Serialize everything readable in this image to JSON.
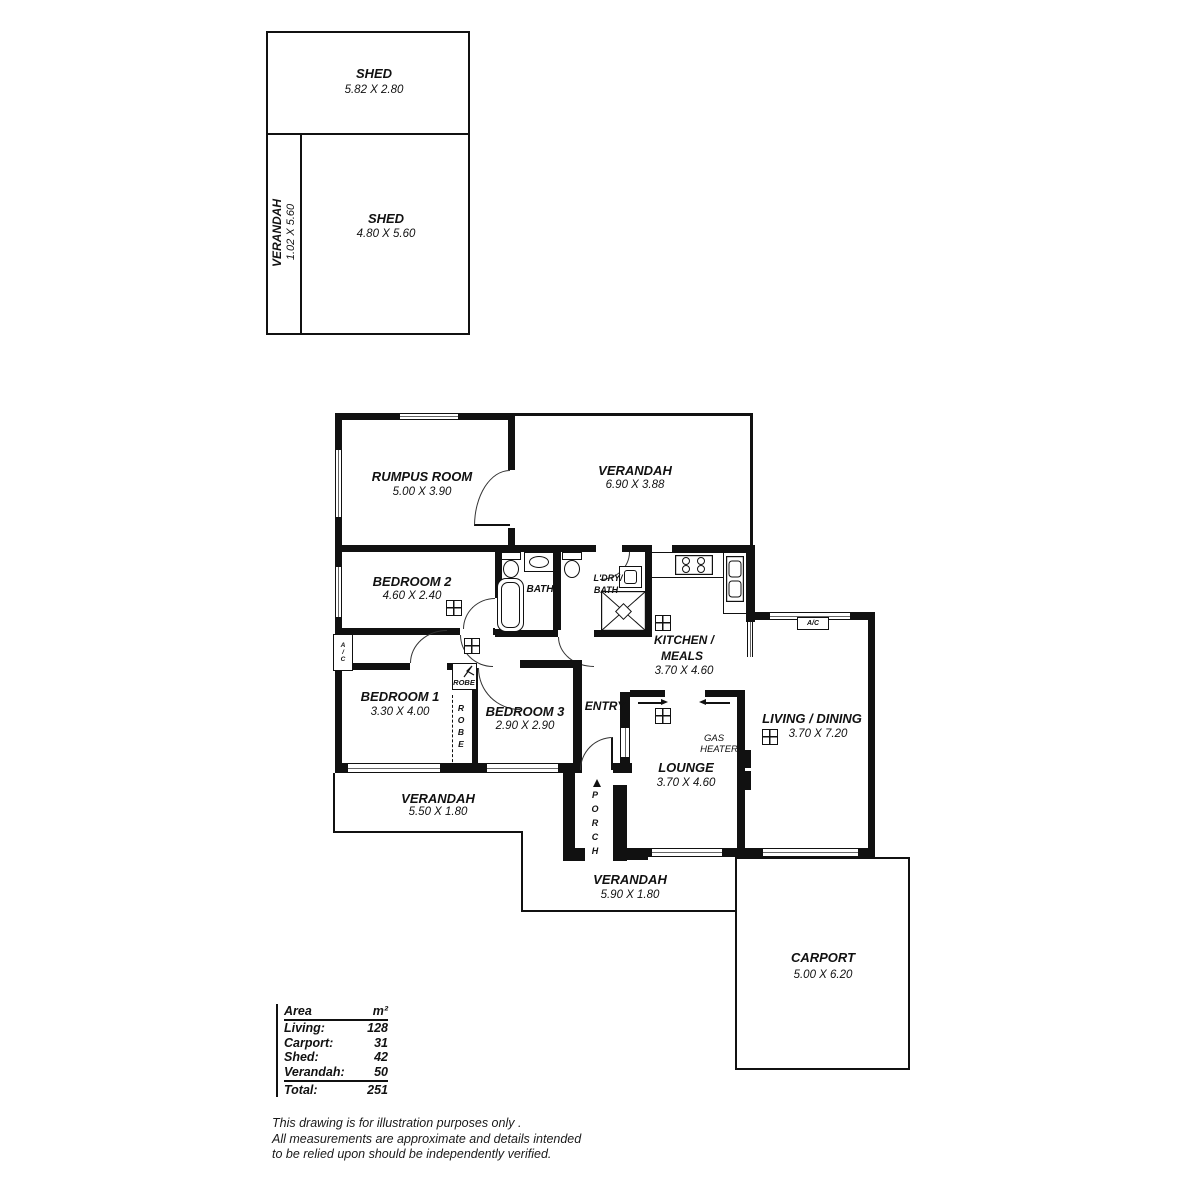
{
  "shed_block": {
    "shed1": {
      "name": "SHED",
      "dims": "5.82 X 2.80"
    },
    "verandah": {
      "name": "VERANDAH",
      "dims": "1.02 X 5.60"
    },
    "shed2": {
      "name": "SHED",
      "dims": "4.80 X 5.60"
    }
  },
  "house": {
    "rumpus": {
      "name": "RUMPUS ROOM",
      "dims": "5.00 X 3.90"
    },
    "verandah_top": {
      "name": "VERANDAH",
      "dims": "6.90 X 3.88"
    },
    "bedroom2": {
      "name": "BEDROOM 2",
      "dims": "4.60 X 2.40"
    },
    "bath": {
      "name": "BATH"
    },
    "ldry_bath": {
      "line1": "L'DRY/",
      "line2": "BATH"
    },
    "kitchen": {
      "line1": "KITCHEN /",
      "line2": "MEALS",
      "dims": "3.70 X 4.60"
    },
    "bedroom1": {
      "name": "BEDROOM 1",
      "dims": "3.30 X 4.00"
    },
    "bedroom3": {
      "name": "BEDROOM 3",
      "dims": "2.90 X 2.90"
    },
    "entry": {
      "name": "ENTRY"
    },
    "lounge": {
      "name": "LOUNGE",
      "dims": "3.70 X 4.60"
    },
    "living_dining": {
      "name": "LIVING / DINING",
      "dims": "3.70 X 7.20"
    },
    "gas_heater": {
      "line1": "GAS",
      "line2": "HEATER"
    },
    "verandah_left": {
      "name": "VERANDAH",
      "dims": "5.50 X 1.80"
    },
    "verandah_bottom": {
      "name": "VERANDAH",
      "dims": "5.90 X 1.80"
    },
    "porch": {
      "name": "PORCH"
    },
    "carport": {
      "name": "CARPORT",
      "dims": "5.00 X 6.20"
    },
    "robe_small": {
      "name": "ROBE"
    },
    "robe_tall": {
      "name": "ROBE"
    },
    "ac_left": {
      "name": "A/C"
    },
    "ac_living": {
      "name": "A/C"
    }
  },
  "area_table": {
    "header": {
      "label": "Area",
      "unit": "m²"
    },
    "rows": [
      {
        "label": "Living:",
        "value": "128"
      },
      {
        "label": "Carport:",
        "value": "31"
      },
      {
        "label": "Shed:",
        "value": "42"
      },
      {
        "label": "Verandah:",
        "value": "50"
      }
    ],
    "total": {
      "label": "Total:",
      "value": "251"
    }
  },
  "disclaimer": {
    "line1": "This drawing is for illustration purposes only .",
    "line2": "All measurements are approximate and details intended",
    "line3": "to be relied upon should be independently verified."
  },
  "colors": {
    "wall": "#111111",
    "text": "#111111",
    "background": "#ffffff"
  }
}
